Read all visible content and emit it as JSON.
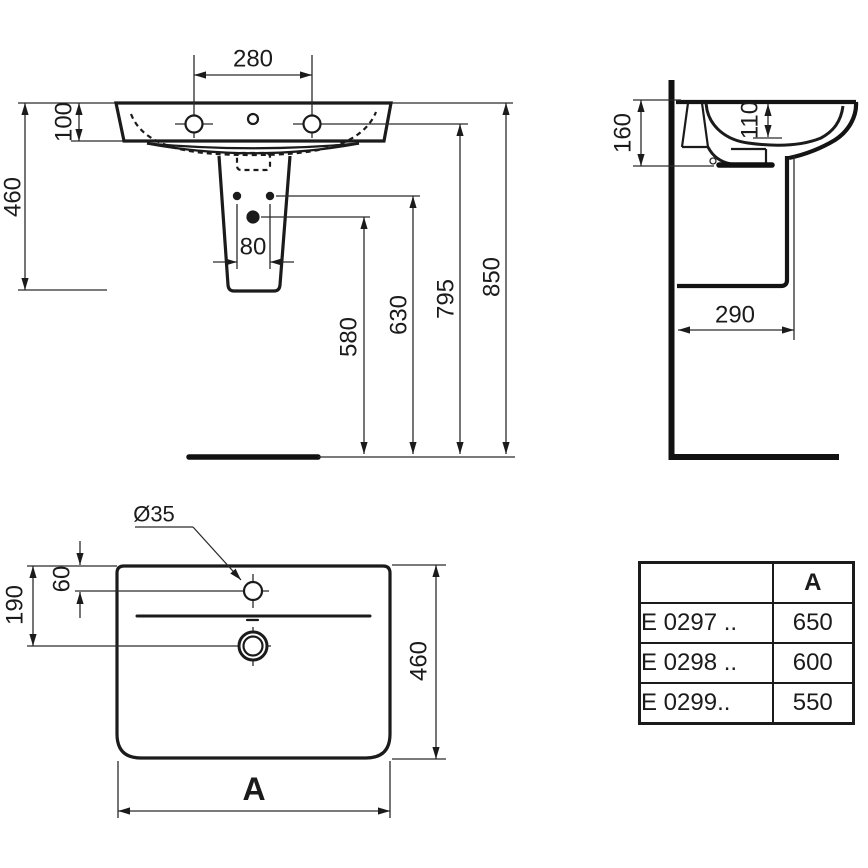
{
  "front_view": {
    "tap_spacing": "280",
    "deck_height": "100",
    "basin_pedestal_height": "460",
    "fixing_hole_spacing": "80",
    "drain_height": "580",
    "fixing_height": "630",
    "underside_height": "795",
    "top_height": "850"
  },
  "side_view": {
    "back_height": "160",
    "bowl_depth": "110",
    "pedestal_depth": "290"
  },
  "plan_view": {
    "tap_hole_diameter": "Ø35",
    "tap_offset": "60",
    "drain_offset": "190",
    "depth": "460",
    "width_label": "A"
  },
  "table": {
    "col_a_header": "A",
    "rows": [
      {
        "model": "E 0297 ..",
        "width": "650"
      },
      {
        "model": "E 0298 ..",
        "width": "600"
      },
      {
        "model": "E 0299..",
        "width": "550"
      }
    ]
  },
  "colors": {
    "line": "#1b1b1b",
    "background": "#ffffff"
  }
}
